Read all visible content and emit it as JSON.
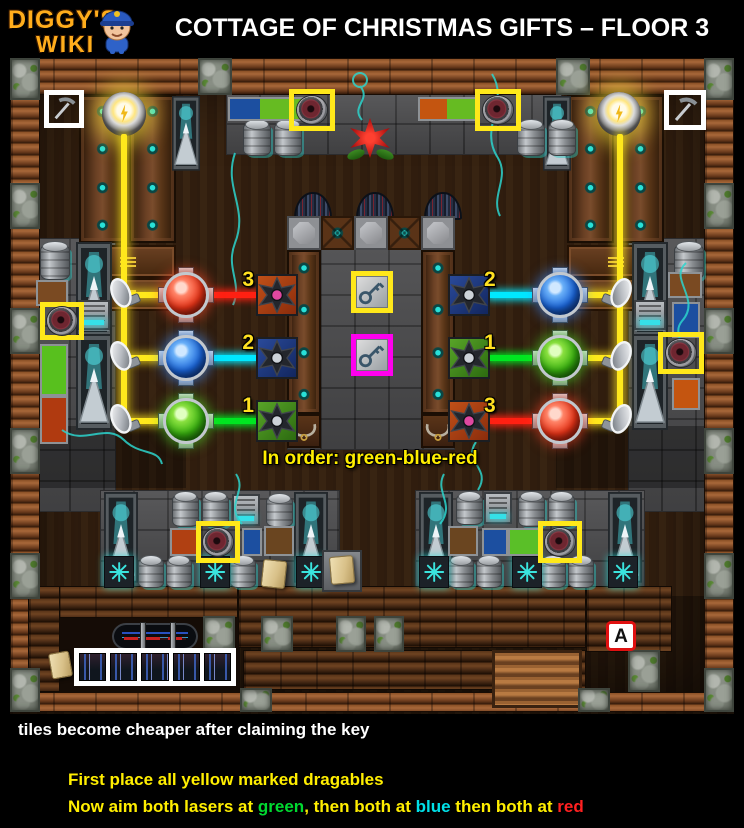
{
  "header": {
    "logo_line1": "DIGGY'S",
    "logo_line2": "WIKI",
    "title": "COTTAGE OF CHRISTMAS GIFTS – FLOOR 3"
  },
  "map": {
    "note": "In order: green-blue-red",
    "area_label": "A",
    "laser_rows_left": [
      {
        "number": "3",
        "target": "red"
      },
      {
        "number": "2",
        "target": "blue"
      },
      {
        "number": "1",
        "target": "green"
      }
    ],
    "laser_rows_right": [
      {
        "number": "2",
        "target": "blue"
      },
      {
        "number": "1",
        "target": "green"
      },
      {
        "number": "3",
        "target": "red"
      }
    ]
  },
  "colors": {
    "marker_yellow": "#ffe81a",
    "marker_magenta": "#ff00ee",
    "marker_white": "#ffffff",
    "laser_yellow": "#ffe81c",
    "laser_red": "#ff2012",
    "laser_cyan": "#00e8ff",
    "laser_green": "#00e621",
    "note_yellow": "#ffee00",
    "badge_border_red": "#e01010"
  },
  "footer": {
    "line1": "tiles become cheaper after claiming the key",
    "line2": "First place all yellow marked dragables",
    "line3": [
      {
        "text": "Now aim both lasers at ",
        "color": "#ffee00"
      },
      {
        "text": "green",
        "color": "#00d930"
      },
      {
        "text": ", then both at ",
        "color": "#ffee00"
      },
      {
        "text": "blue",
        "color": "#00e0e8"
      },
      {
        "text": " then both at ",
        "color": "#ffee00"
      },
      {
        "text": "red",
        "color": "#ff2020"
      }
    ]
  }
}
